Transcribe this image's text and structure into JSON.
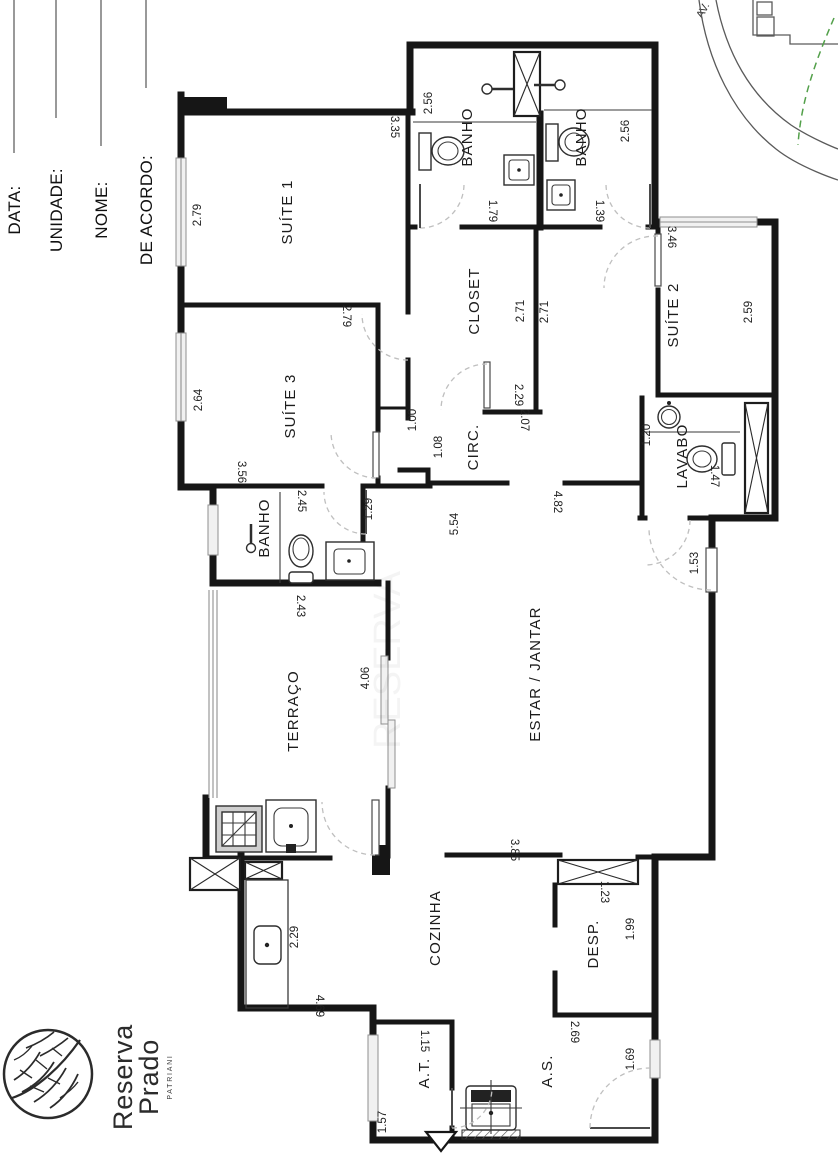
{
  "title_block": {
    "fields": [
      {
        "label": "DATA:"
      },
      {
        "label": "UNIDADE:"
      },
      {
        "label": "NOME:"
      },
      {
        "label": "DE ACORDO:"
      }
    ]
  },
  "site_map": {
    "avenue_label": "AV."
  },
  "logo": {
    "name_line1": "Reserva",
    "name_line2": "Prado",
    "brand": "PATRIANI"
  },
  "watermark": "RESERVA",
  "rooms": {
    "suite1": {
      "name": "SUÍTE 1",
      "d1": "2.79",
      "d2": "3.35"
    },
    "suite2": {
      "name": "SUÍTE 2",
      "d1": "3.46",
      "d2": "2.59"
    },
    "suite3": {
      "name": "SUÍTE 3",
      "d1": "2.64",
      "d2": "2.79",
      "d3": "3.56"
    },
    "banho1": {
      "name": "BANHO",
      "d1": "2.56",
      "d2": "1.79"
    },
    "banho2": {
      "name": "BANHO",
      "d1": "2.56",
      "d2": "1.39"
    },
    "banho3": {
      "name": "BANHO",
      "d1": "2.45",
      "d2": "1.29"
    },
    "closet": {
      "name": "CLOSET",
      "d1": "2.71",
      "d2": "2.71",
      "d3": "2.29"
    },
    "circ": {
      "name": "CIRC.",
      "d1": "2.07",
      "d2": "1.00",
      "d3": "1.08"
    },
    "lavabo": {
      "name": "LAVABO",
      "d1": "1.20",
      "d2": "1.47"
    },
    "estar": {
      "name": "ESTAR / JANTAR",
      "d1": "5.54",
      "d2": "4.82",
      "d3": "1.53"
    },
    "terraco": {
      "name": "TERRAÇO",
      "d1": "2.43",
      "d2": "4.06"
    },
    "cozinha": {
      "name": "COZINHA",
      "d1": "2.29",
      "d2": "4.69",
      "d3": "3.85"
    },
    "desp": {
      "name": "DESP.",
      "d1": "1.23",
      "d2": "1.99"
    },
    "at": {
      "name": "A.T.",
      "d1": "1.15",
      "d2": "1.57"
    },
    "as": {
      "name": "A.S.",
      "d1": "2.69",
      "d2": "1.69"
    }
  },
  "colors": {
    "wall": "#161616",
    "window": "#8f8f8f",
    "door_arc": "#bfbfbf",
    "site_green": "#53a04a"
  }
}
